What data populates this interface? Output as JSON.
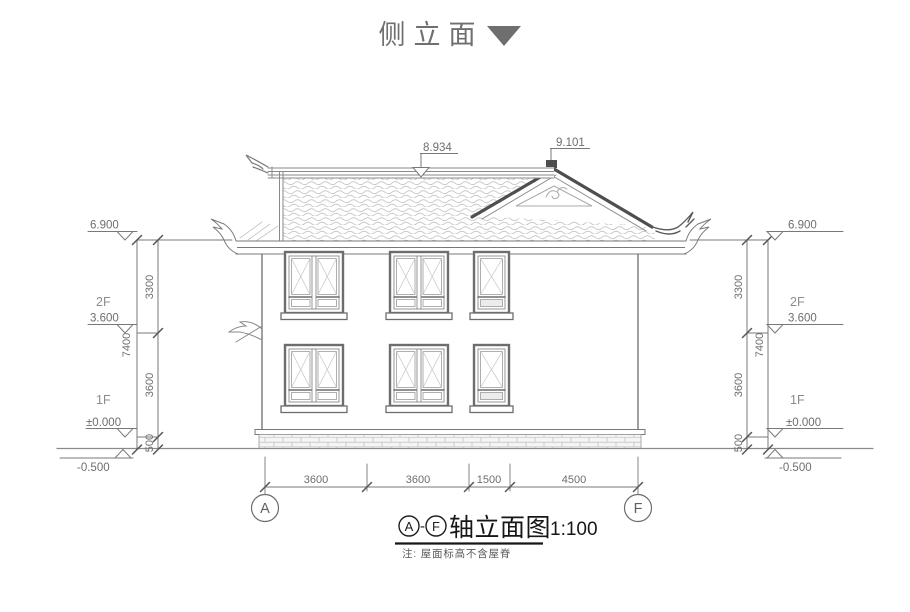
{
  "header": {
    "title": "侧立面"
  },
  "elevation_labels": {
    "roof_surface": "8.934",
    "ridge_top": "9.101",
    "eave": "6.900",
    "floor2": "3.600",
    "ground": "±0.000",
    "site": "-0.500"
  },
  "floor_labels": {
    "f2": "2F",
    "f1": "1F"
  },
  "vertical_dims": {
    "total": "7400",
    "seg_top": "3300",
    "seg_mid": "3600",
    "seg_bottom": "500"
  },
  "horizontal_dims": {
    "seg1": "3600",
    "seg2": "3600",
    "seg3": "1500",
    "seg4": "4500"
  },
  "axis_bubbles": {
    "left": "A",
    "right": "F"
  },
  "footer": {
    "axis_start": "A",
    "separator": "-",
    "axis_end": "F",
    "title": "轴立面图",
    "scale": "1:100",
    "note": "注: 屋面标高不含屋脊"
  }
}
